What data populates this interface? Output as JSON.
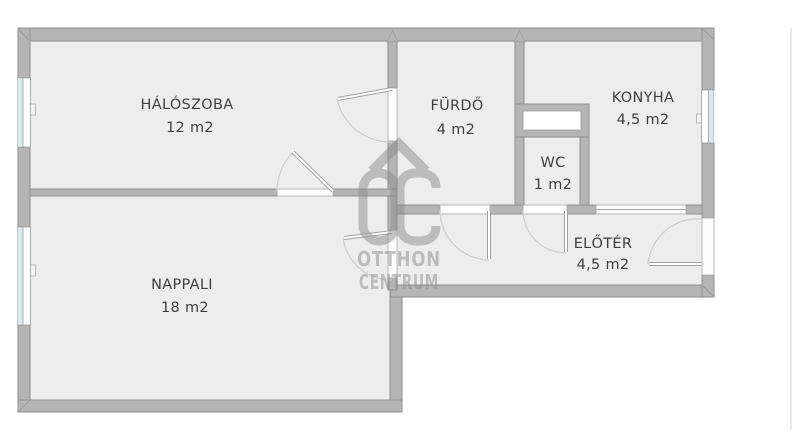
{
  "floorplan": {
    "rooms": [
      {
        "id": "haloszoba",
        "name": "HÁLÓSZOBA",
        "area": "12 m2"
      },
      {
        "id": "nappali",
        "name": "NAPPALI",
        "area": "18 m2"
      },
      {
        "id": "furdo",
        "name": "FÜRDŐ",
        "area": "4 m2"
      },
      {
        "id": "wc",
        "name": "WC",
        "area": "1 m2"
      },
      {
        "id": "konyha",
        "name": "KONYHA",
        "area": "4,5 m2"
      },
      {
        "id": "eloter",
        "name": "ELŐTÉR",
        "area": "4,5 m2"
      }
    ],
    "watermark": {
      "monogram": "OC",
      "line1": "OTTHON",
      "line2": "CENTRUM"
    },
    "features": {
      "windows": 3,
      "doors": 6,
      "entrance_wall": "right",
      "shaft": "duct above WC"
    },
    "colors": {
      "wall": "#b5b5b5",
      "floor": "#ededed",
      "glass": "#d9eaf0",
      "room_text": "#3f3f3f",
      "watermark": "#8c8c8c"
    }
  }
}
